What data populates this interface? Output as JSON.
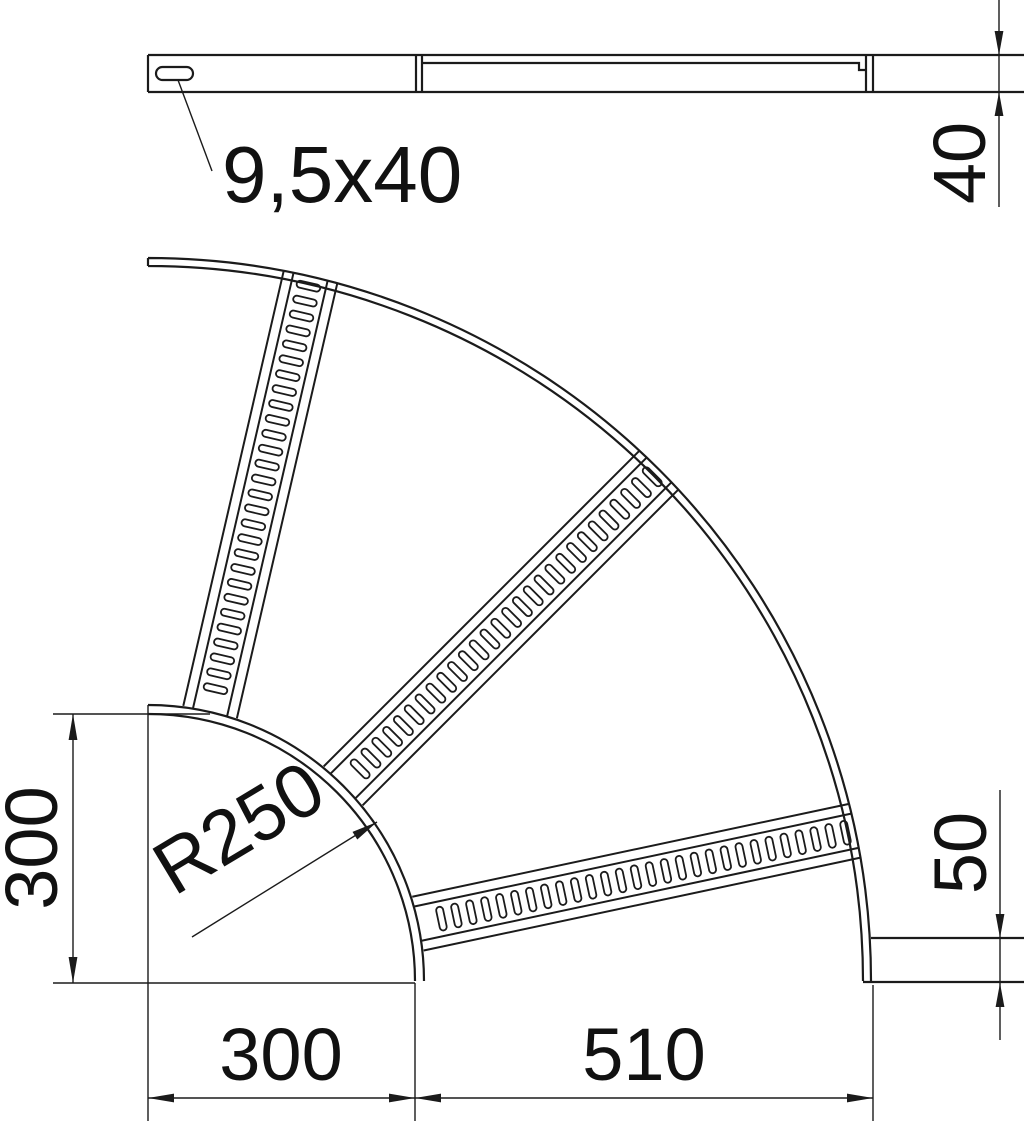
{
  "drawing": {
    "type": "technical-drawing-cable-ladder-90-degree-bend",
    "line_color": "#1b1b1b",
    "background": "#ffffff",
    "side_view": {
      "slot_label": "9,5x40",
      "rail_height_dim": "40"
    },
    "plan_view": {
      "radius_label": "R250",
      "left_height_dim": "300",
      "bottom_left_dim": "300",
      "bottom_right_dim": "510",
      "rail_width_dim": "50"
    }
  }
}
